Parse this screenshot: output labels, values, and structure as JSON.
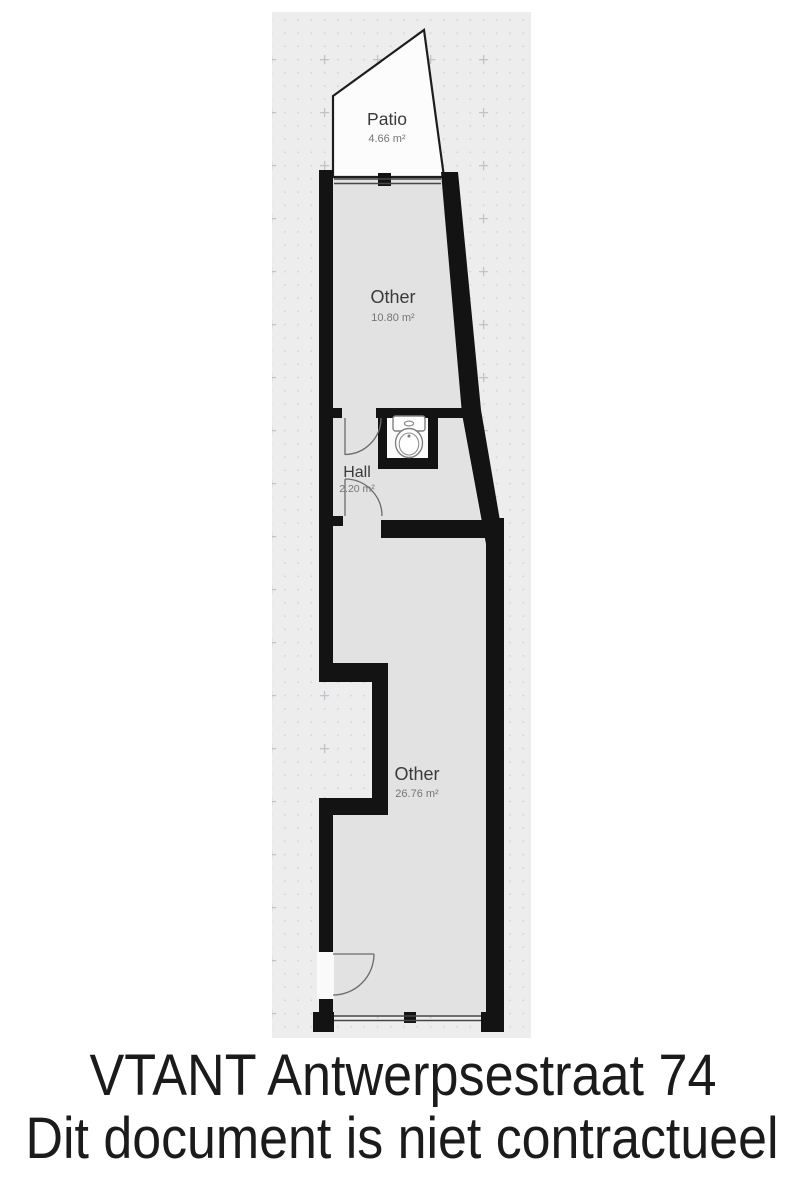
{
  "floorplan": {
    "rooms": [
      {
        "name": "Patio",
        "area": "4.66 m²"
      },
      {
        "name": "Other",
        "area": "10.80 m²"
      },
      {
        "name": "Hall",
        "area": "2.20 m²"
      },
      {
        "name": "Other",
        "area": "26.76 m²"
      }
    ],
    "fixtures": [
      "toilet"
    ],
    "colors": {
      "wall": "#131313",
      "room_fill": "#e2e2e2",
      "canvas_bg": "#ededed",
      "patio_fill": "#fcfcfc",
      "dot_grid": "#d4d4da"
    }
  },
  "footer": {
    "line1": "VTANT Antwerpsestraat 74",
    "line2": "Dit document is niet contractueel"
  }
}
